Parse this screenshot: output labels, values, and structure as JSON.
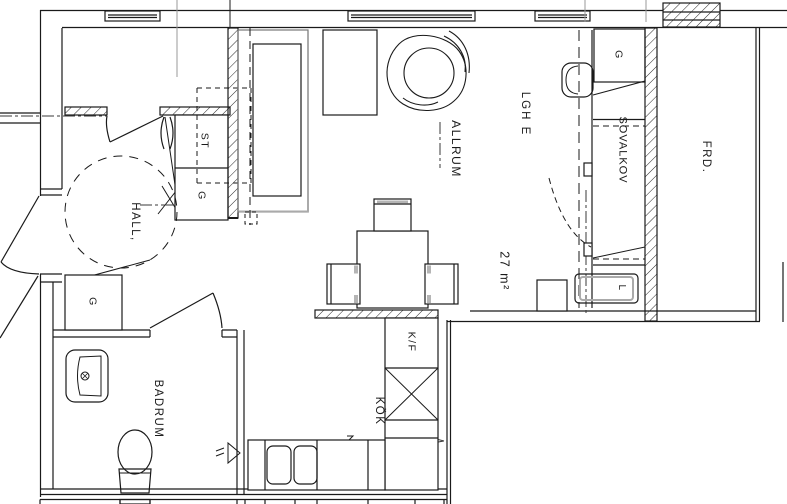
{
  "plan": {
    "unit": {
      "id_label": "LGH E",
      "area_label": "27 m²"
    },
    "rooms": {
      "hall": "HALL,",
      "living": "ALLRUM",
      "sleeping_alcove": "SOVALKOV",
      "kitchen": "KÖK",
      "bathroom": "BADRUM",
      "storage": "FRD."
    },
    "closets": {
      "cleaning": "ST",
      "wardrobe_hall_upper": "G",
      "wardrobe_hall_lower": "G",
      "wardrobe_alcove": "G"
    },
    "appliances": {
      "fridge_freezer": "K/F",
      "laundry": "L"
    }
  }
}
